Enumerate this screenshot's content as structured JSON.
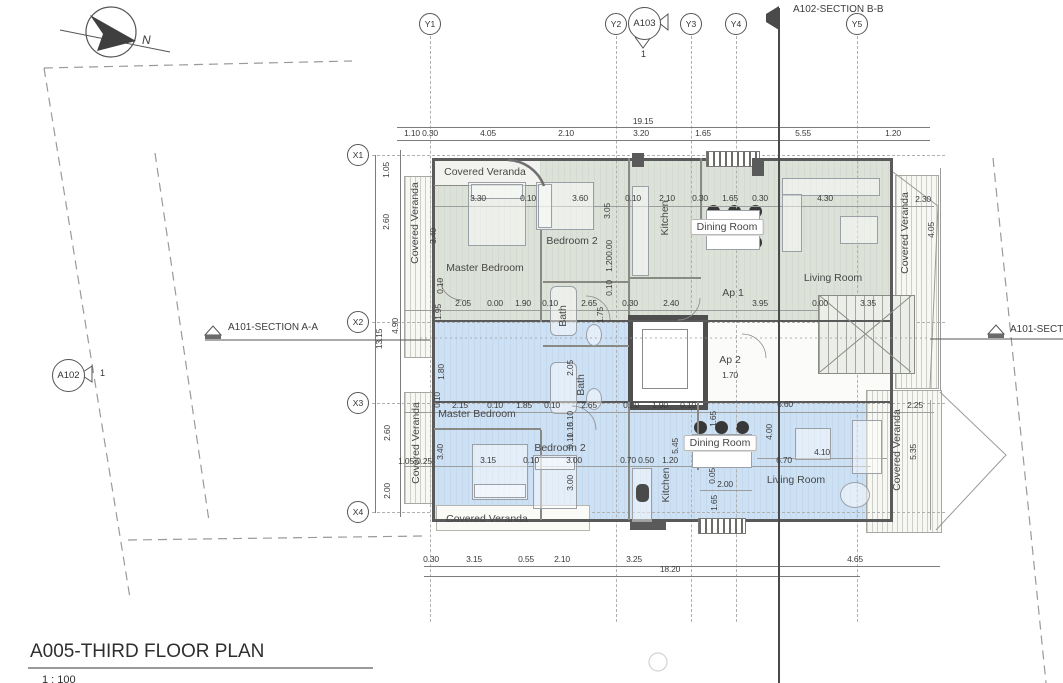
{
  "title_block": {
    "title": "A005-THIRD FLOOR PLAN",
    "scale": "1 : 100"
  },
  "north_label": "N",
  "section_markers": {
    "bb_top": "A102-SECTION B-B",
    "aa_left": "A101-SECTION A-A",
    "aa_right": "A101-SECTION A-A"
  },
  "callouts": {
    "a103": {
      "label": "A103",
      "num": "1"
    },
    "a102": {
      "label": "A102",
      "num": "1"
    }
  },
  "grid": {
    "cols": [
      {
        "label": "Y1",
        "x": 430
      },
      {
        "label": "Y2",
        "x": 616
      },
      {
        "label": "Y3",
        "x": 691
      },
      {
        "label": "Y4",
        "x": 736
      },
      {
        "label": "Y5",
        "x": 857
      }
    ],
    "rows": [
      {
        "label": "X1",
        "y": 155
      },
      {
        "label": "X2",
        "y": 322
      },
      {
        "label": "X3",
        "y": 403
      },
      {
        "label": "X4",
        "y": 512
      }
    ]
  },
  "rooms": [
    {
      "t": "Covered Veranda",
      "x": 485,
      "y": 172
    },
    {
      "t": "Covered Veranda",
      "x": 415,
      "y": 223,
      "r": 1
    },
    {
      "t": "Master Bedroom",
      "x": 485,
      "y": 268
    },
    {
      "t": "Bedroom 2",
      "x": 572,
      "y": 241
    },
    {
      "t": "Kitchen",
      "x": 665,
      "y": 218,
      "r": 1
    },
    {
      "t": "Dining Room",
      "x": 727,
      "y": 227,
      "box": 1
    },
    {
      "t": "Living Room",
      "x": 833,
      "y": 278
    },
    {
      "t": "Bath",
      "x": 563,
      "y": 316,
      "r": 1
    },
    {
      "t": "Ap 1",
      "x": 733,
      "y": 293
    },
    {
      "t": "Covered Veranda",
      "x": 905,
      "y": 233,
      "r": 1
    },
    {
      "t": "Master Bedroom",
      "x": 477,
      "y": 414
    },
    {
      "t": "Bedroom 2",
      "x": 560,
      "y": 448
    },
    {
      "t": "Kitchen",
      "x": 666,
      "y": 485,
      "r": 1
    },
    {
      "t": "Dining Room",
      "x": 720,
      "y": 443,
      "box": 1
    },
    {
      "t": "Living Room",
      "x": 796,
      "y": 480
    },
    {
      "t": "Bath",
      "x": 581,
      "y": 385,
      "r": 1
    },
    {
      "t": "Ap 2",
      "x": 730,
      "y": 360
    },
    {
      "t": "Covered Veranda",
      "x": 416,
      "y": 443,
      "r": 1
    },
    {
      "t": "Covered Veranda",
      "x": 897,
      "y": 450,
      "r": 1
    },
    {
      "t": "Covered Veranda",
      "x": 487,
      "y": 519
    }
  ],
  "dims": [
    {
      "v": "19.15",
      "x": 643,
      "y": 121
    },
    {
      "v": "1.10",
      "x": 412,
      "y": 133
    },
    {
      "v": "0.30",
      "x": 430,
      "y": 133
    },
    {
      "v": "4.05",
      "x": 488,
      "y": 133
    },
    {
      "v": "2.10",
      "x": 566,
      "y": 133
    },
    {
      "v": "3.20",
      "x": 641,
      "y": 133
    },
    {
      "v": "1.65",
      "x": 703,
      "y": 133
    },
    {
      "v": "5.55",
      "x": 803,
      "y": 133
    },
    {
      "v": "1.20",
      "x": 893,
      "y": 133
    },
    {
      "v": "3.30",
      "x": 478,
      "y": 198
    },
    {
      "v": "0.10",
      "x": 528,
      "y": 198
    },
    {
      "v": "3.60",
      "x": 580,
      "y": 198
    },
    {
      "v": "0.10",
      "x": 633,
      "y": 198
    },
    {
      "v": "2.10",
      "x": 667,
      "y": 198
    },
    {
      "v": "0.30",
      "x": 700,
      "y": 198
    },
    {
      "v": "1.65",
      "x": 730,
      "y": 198
    },
    {
      "v": "0.30",
      "x": 760,
      "y": 198
    },
    {
      "v": "4.30",
      "x": 825,
      "y": 198
    },
    {
      "v": "2.30",
      "x": 923,
      "y": 199
    },
    {
      "v": "3.05",
      "x": 607,
      "y": 211,
      "r": 1
    },
    {
      "v": "4.05",
      "x": 931,
      "y": 230,
      "r": 1
    },
    {
      "v": "3.40",
      "x": 433,
      "y": 236,
      "r": 1
    },
    {
      "v": "1.05",
      "x": 386,
      "y": 170,
      "r": 1
    },
    {
      "v": "2.60",
      "x": 386,
      "y": 222,
      "r": 1
    },
    {
      "v": "2.05",
      "x": 463,
      "y": 303
    },
    {
      "v": "0.00",
      "x": 495,
      "y": 303
    },
    {
      "v": "1.90",
      "x": 523,
      "y": 303
    },
    {
      "v": "0.10",
      "x": 550,
      "y": 303
    },
    {
      "v": "2.65",
      "x": 589,
      "y": 303
    },
    {
      "v": "0.30",
      "x": 630,
      "y": 303
    },
    {
      "v": "2.40",
      "x": 671,
      "y": 303
    },
    {
      "v": "3.95",
      "x": 760,
      "y": 303
    },
    {
      "v": "0.00",
      "x": 820,
      "y": 303
    },
    {
      "v": "3.35",
      "x": 868,
      "y": 303
    },
    {
      "v": "0.10",
      "x": 440,
      "y": 286,
      "r": 1
    },
    {
      "v": "1.95",
      "x": 438,
      "y": 312,
      "r": 1
    },
    {
      "v": "4.90",
      "x": 395,
      "y": 326,
      "r": 1
    },
    {
      "v": "13.15",
      "x": 379,
      "y": 339,
      "r": 1
    },
    {
      "v": "1.75",
      "x": 600,
      "y": 315,
      "r": 1
    },
    {
      "v": "0.10",
      "x": 609,
      "y": 288,
      "r": 1
    },
    {
      "v": "1.20",
      "x": 609,
      "y": 264,
      "r": 1
    },
    {
      "v": "0.00",
      "x": 609,
      "y": 248,
      "r": 1
    },
    {
      "v": "2.15",
      "x": 460,
      "y": 405
    },
    {
      "v": "0.10",
      "x": 495,
      "y": 405
    },
    {
      "v": "1.85",
      "x": 524,
      "y": 405
    },
    {
      "v": "0.10",
      "x": 552,
      "y": 405
    },
    {
      "v": "2.65",
      "x": 589,
      "y": 405
    },
    {
      "v": "0.20",
      "x": 631,
      "y": 405
    },
    {
      "v": "1.90",
      "x": 660,
      "y": 405
    },
    {
      "v": "0.10",
      "x": 688,
      "y": 405
    },
    {
      "v": "6.60",
      "x": 785,
      "y": 404
    },
    {
      "v": "2.25",
      "x": 915,
      "y": 405
    },
    {
      "v": "1.80",
      "x": 441,
      "y": 372,
      "r": 1
    },
    {
      "v": "0.10",
      "x": 437,
      "y": 400,
      "r": 1
    },
    {
      "v": "2.05",
      "x": 570,
      "y": 368,
      "r": 1
    },
    {
      "v": "0.10",
      "x": 570,
      "y": 419,
      "r": 1
    },
    {
      "v": "1.15",
      "x": 570,
      "y": 430,
      "r": 1
    },
    {
      "v": "0.10",
      "x": 570,
      "y": 441,
      "r": 1
    },
    {
      "v": "2.60",
      "x": 387,
      "y": 433,
      "r": 1
    },
    {
      "v": "2.00",
      "x": 387,
      "y": 491,
      "r": 1
    },
    {
      "v": "1.70",
      "x": 730,
      "y": 375
    },
    {
      "v": "1.05",
      "x": 406,
      "y": 461
    },
    {
      "v": "0.25",
      "x": 424,
      "y": 461
    },
    {
      "v": "3.15",
      "x": 488,
      "y": 460
    },
    {
      "v": "0.10",
      "x": 531,
      "y": 460
    },
    {
      "v": "3.00",
      "x": 574,
      "y": 460
    },
    {
      "v": "0.70",
      "x": 628,
      "y": 460
    },
    {
      "v": "0.50",
      "x": 646,
      "y": 460
    },
    {
      "v": "1.20",
      "x": 670,
      "y": 460
    },
    {
      "v": "6.70",
      "x": 784,
      "y": 460
    },
    {
      "v": "4.10",
      "x": 822,
      "y": 452
    },
    {
      "v": "3.40",
      "x": 440,
      "y": 452,
      "r": 1
    },
    {
      "v": "3.00",
      "x": 570,
      "y": 483,
      "r": 1
    },
    {
      "v": "5.45",
      "x": 675,
      "y": 446,
      "r": 1
    },
    {
      "v": "4.00",
      "x": 769,
      "y": 432,
      "r": 1
    },
    {
      "v": "1.65",
      "x": 713,
      "y": 419,
      "r": 1
    },
    {
      "v": "5.35",
      "x": 913,
      "y": 452,
      "r": 1
    },
    {
      "v": "2.00",
      "x": 725,
      "y": 484
    },
    {
      "v": "0.05",
      "x": 712,
      "y": 476,
      "r": 1
    },
    {
      "v": "1.65",
      "x": 714,
      "y": 503,
      "r": 1
    },
    {
      "v": "0.30",
      "x": 431,
      "y": 559
    },
    {
      "v": "3.15",
      "x": 474,
      "y": 559
    },
    {
      "v": "0.55",
      "x": 526,
      "y": 559
    },
    {
      "v": "2.10",
      "x": 562,
      "y": 559
    },
    {
      "v": "3.25",
      "x": 634,
      "y": 559
    },
    {
      "v": "18.20",
      "x": 670,
      "y": 569
    },
    {
      "v": "4.65",
      "x": 855,
      "y": 559
    }
  ],
  "colors": {
    "ap1_fill": "#dde2d9",
    "ap2_fill": "#cde1f5",
    "wall": "#5a5a5a",
    "dim_text": "#3b3b3b"
  }
}
